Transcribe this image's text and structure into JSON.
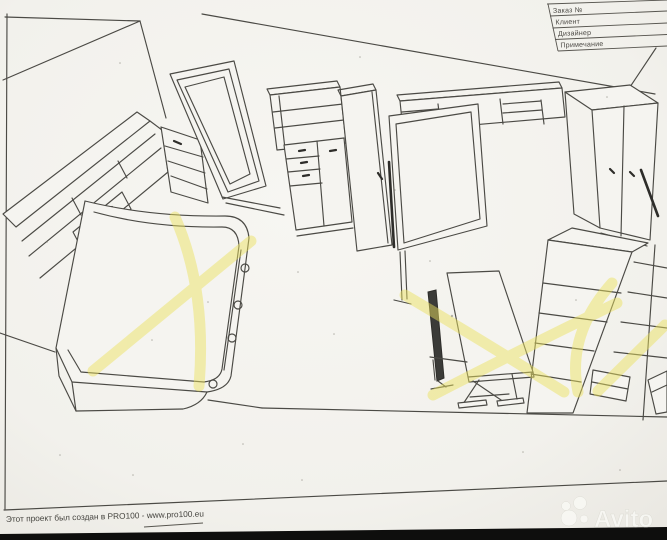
{
  "title_block": {
    "rows": [
      {
        "label": "Заказ №"
      },
      {
        "label": "Клиент"
      },
      {
        "label": "Дизайнер"
      },
      {
        "label": "Примечание"
      }
    ]
  },
  "footer": {
    "credit_prefix": "Этот проект был создан в PRO100 - ",
    "credit_url": "www.pro100.eu"
  },
  "watermark": {
    "brand": "Avito"
  },
  "colors": {
    "paper": "#f4f3ef",
    "ink": "#4b4a45",
    "highlighter": "#ece25f",
    "bottom_bar": "#0e0e0d",
    "watermark": "#f8f8f4"
  },
  "drawing": {
    "kind": "3d-room-furniture-sketch",
    "highlight_marks": [
      {
        "shape": "x-cross",
        "over": "sofa-bed"
      },
      {
        "shape": "x-cross",
        "over": "desk-with-monitor"
      },
      {
        "shape": "x-cross",
        "over": "corner-shelving"
      }
    ]
  }
}
